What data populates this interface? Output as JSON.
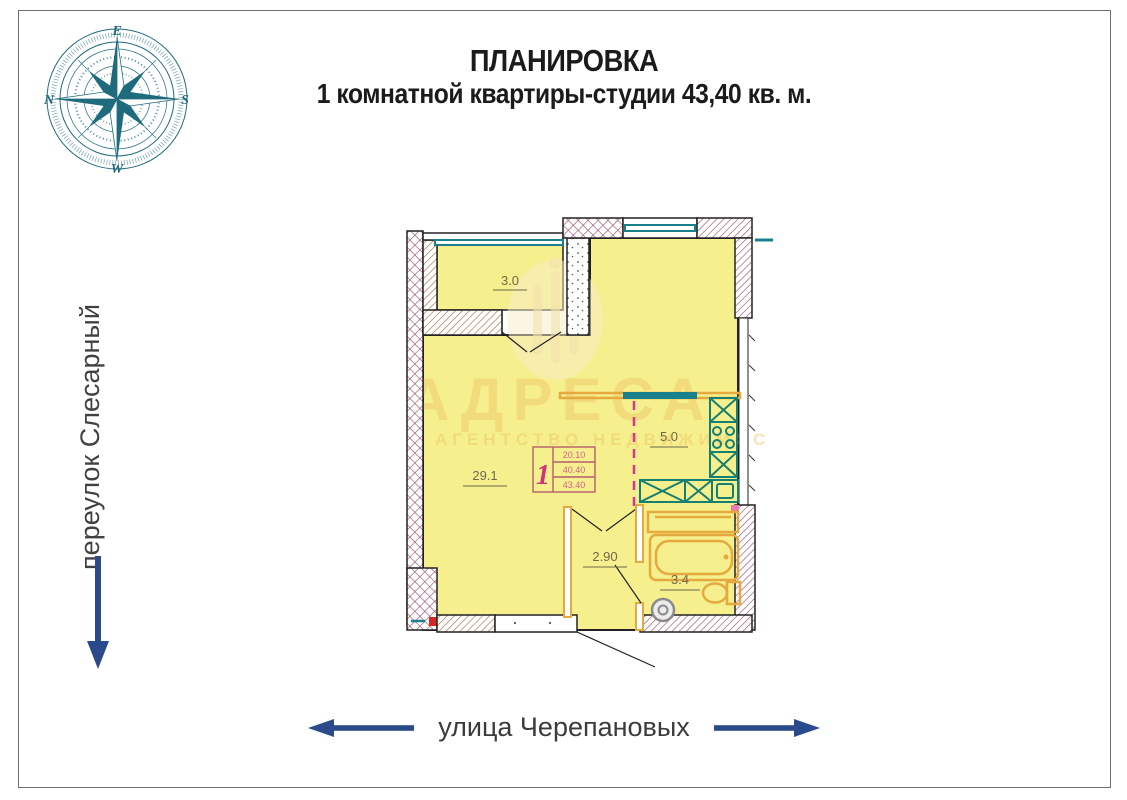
{
  "title": {
    "line1": "ПЛАНИРОВКА",
    "line2": "1 комнатной квартиры-студии 43,40 кв. м."
  },
  "compass": {
    "letters": {
      "top": "E",
      "right": "S",
      "bottom": "W",
      "left": "N"
    }
  },
  "streets": {
    "left": "переулок Слесарный",
    "bottom": "улица Черепановых"
  },
  "watermark": {
    "word": "АДРЕСА",
    "subtitle": "АГЕНТСТВО НЕДВИЖИМОС"
  },
  "plan": {
    "rooms": [
      {
        "name": "loggia",
        "area": "3.0"
      },
      {
        "name": "living-room",
        "area": "29.1"
      },
      {
        "name": "kitchen",
        "area": "5.0"
      },
      {
        "name": "hallway",
        "area": "2.90"
      },
      {
        "name": "bathroom",
        "area": "3.4"
      }
    ],
    "apartment_label": {
      "number": "1",
      "row1": "20.10",
      "row2": "40.40",
      "row3": "43.40"
    }
  },
  "colors": {
    "navy": "#2b4a8c",
    "tealc": "#1e6b7e",
    "wallp": "#9a5573",
    "wallb": "#a8743f",
    "yellow": "#f6ef8d",
    "tealwin": "#19808c",
    "tealapp": "#157f72",
    "orange": "#e5a93d",
    "magenta": "#d6359b",
    "pinkline": "#b85c6e",
    "pinknum": "#d1337a",
    "pinknum2": "#cc6688",
    "labeltext": "#6f684a",
    "wmark": "#f0c96b"
  }
}
